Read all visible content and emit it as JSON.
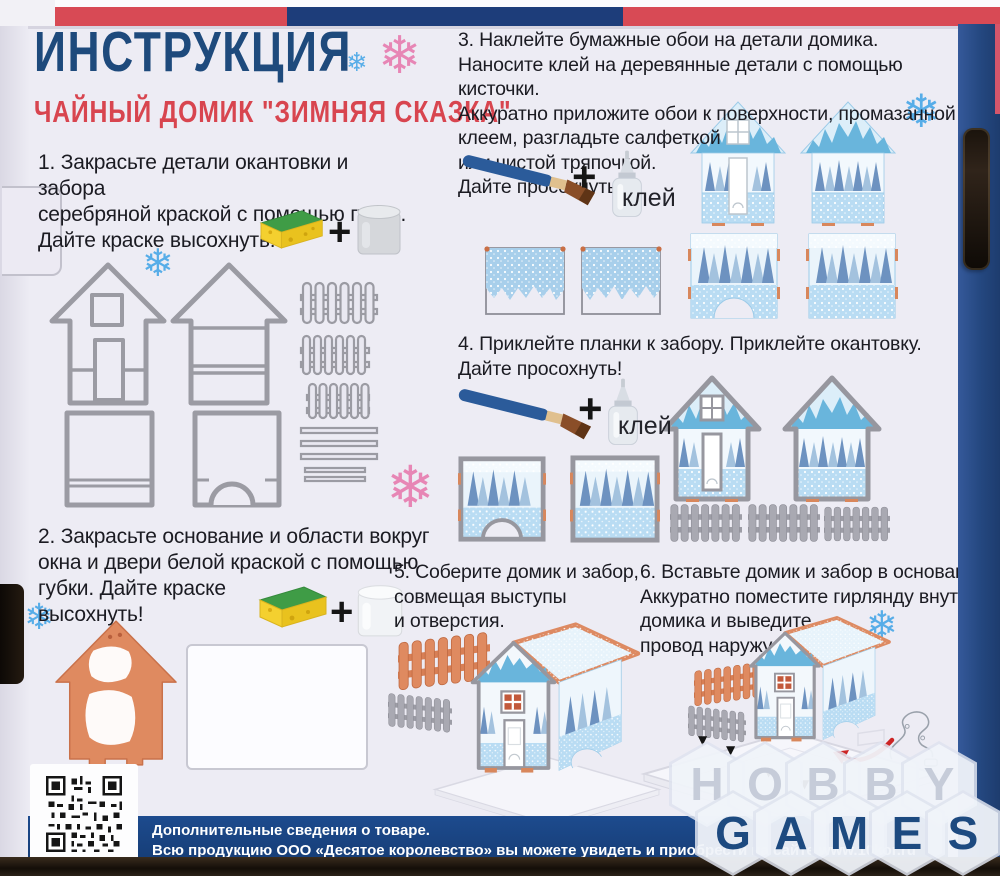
{
  "page": {
    "title": "ИНСТРУКЦИЯ",
    "subtitle": "ЧАЙНЫЙ ДОМИК \"ЗИМНЯЯ СКАЗКА\""
  },
  "steps": [
    {
      "text": "1. Закрасьте детали окантовки и забора\nсеребряной краской с помощью губки.\nДайте краске высохнуть!"
    },
    {
      "text": "2. Закрасьте основание и области вокруг\nокна и двери белой краской с помощью\nгубки. Дайте краске\nвысохнуть!"
    },
    {
      "text": "3. Наклейте бумажные обои  на детали домика.\nНаносите клей на деревянные детали с помощью кисточки.\nАккуратно приложите обои к поверхности, промазанной\nклеем, разгладьте салфеткой\nили чистой тряпочкой.\nДайте просохнуть!"
    },
    {
      "text": "4. Приклейте планки к забору. Приклейте окантовку.\nДайте просохнуть!"
    },
    {
      "text": "5. Соберите домик и забор,\nсовмещая выступы\nи отверстия."
    },
    {
      "text": "6. Вставьте домик и забор в основание.\nАккуратно поместите гирлянду внутрь\nдомика и выведите\nпровод наружу."
    }
  ],
  "labels": {
    "plus": "+",
    "glue": "клей"
  },
  "footer": {
    "line1": "Дополнительные сведения о товаре.",
    "line2": "Всю продукцию ООО «Десятое королевство» вы можете увидеть и приобрести на сайте www.10kor.ru"
  },
  "watermark": {
    "row1": [
      "H",
      "O",
      "B",
      "B",
      "Y"
    ],
    "row2": [
      "G",
      "A",
      "M",
      "E",
      "S"
    ]
  },
  "icons": {
    "snowflake": "❄",
    "arrow_down": "▼"
  },
  "colors": {
    "title_blue": "#1e4a7c",
    "subtitle_red": "#d8454f",
    "paper": "#edecf4",
    "footer_bar_blue": "#1d4b8e",
    "wood_gray": "#9b9ba3",
    "terracotta": "#df8a60",
    "wallpaper_blue": "#b9dcf3",
    "snowflake_blue": "#57ade8",
    "snowflake_pink": "#e786b5"
  }
}
